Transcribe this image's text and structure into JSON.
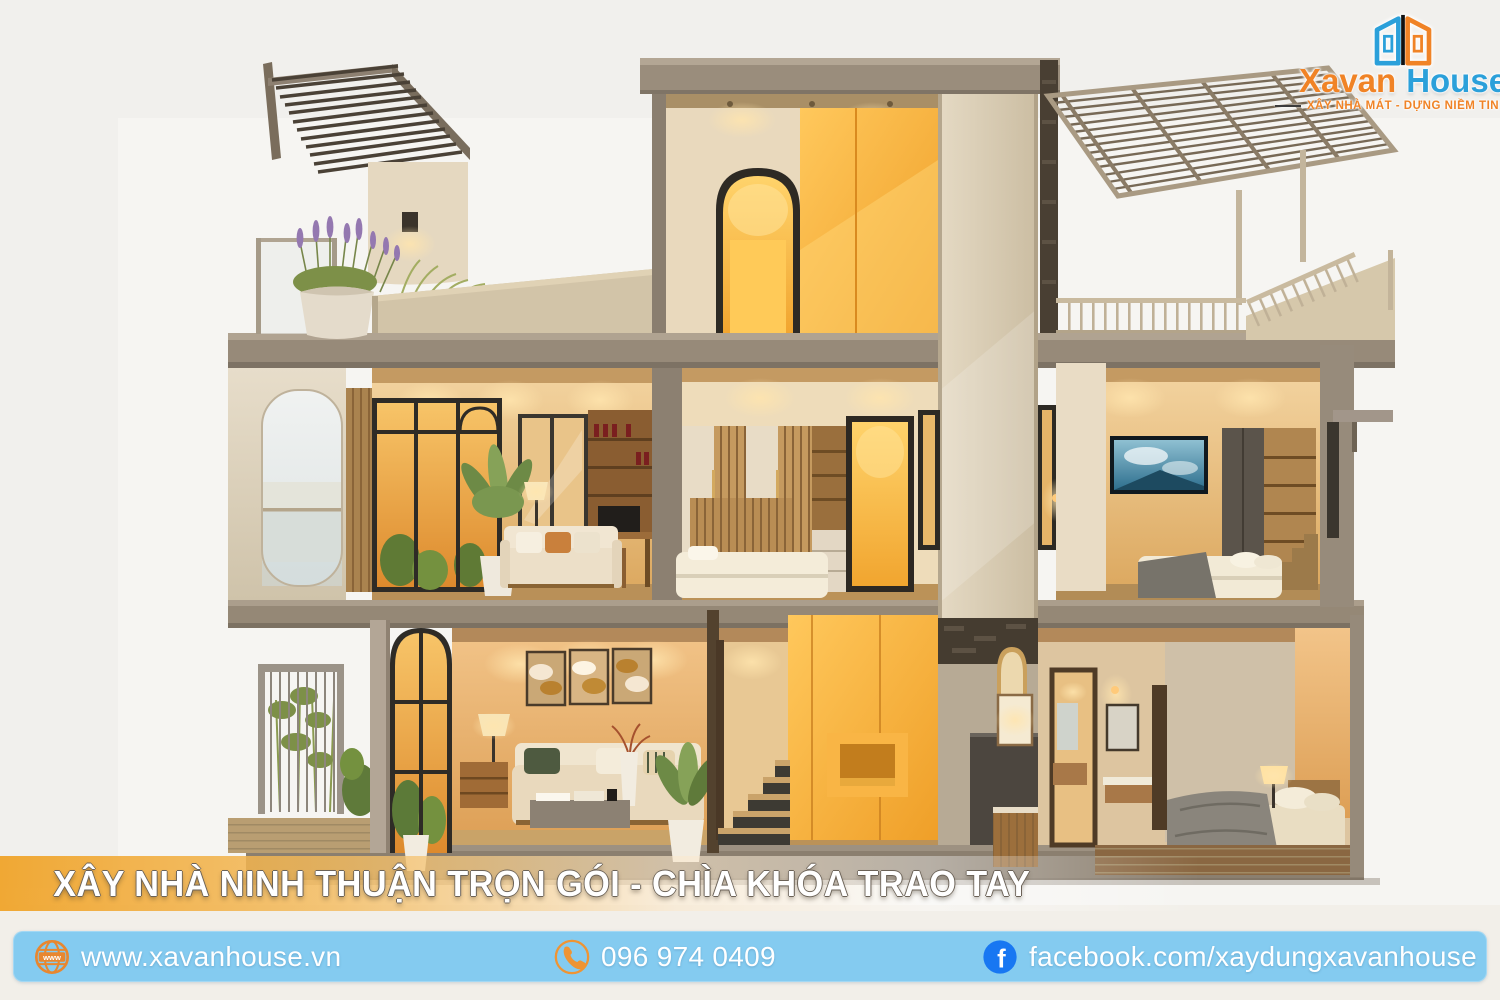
{
  "page": {
    "width": 1500,
    "height": 1000,
    "background": "#f6f5f2"
  },
  "logo": {
    "brand_primary": "Xavan",
    "brand_secondary": "House",
    "tagline": "XÂY NHÀ MÁT - DỰNG NIỀM TIN",
    "colors": {
      "primary_orange": "#f08326",
      "secondary_blue": "#2ba0da",
      "icon_bar": "#101010"
    }
  },
  "banner": {
    "title": "XÂY NHÀ NINH THUẬN TRỌN GÓI - CHÌA KHÓA TRAO TAY",
    "text_color": "#ffffff",
    "gradient_start": "#f1a42e"
  },
  "contact_bar": {
    "background": "#84cbf0",
    "website": {
      "icon": "globe-icon",
      "label": "www.xavanhouse.vn",
      "icon_color": "#e8872f"
    },
    "phone": {
      "icon": "phone-icon",
      "label": "096 974 0409",
      "icon_color": "#ef9433"
    },
    "facebook": {
      "icon": "facebook-icon",
      "label": "facebook.com/xaydungxavanhouse",
      "icon_color": "#1877f2"
    }
  },
  "illustration": {
    "alt": "3D cutaway rendering of a modern 3-storey house with warm interior lighting",
    "accent_yellow": "#f5a93c",
    "concrete": "#948878"
  }
}
